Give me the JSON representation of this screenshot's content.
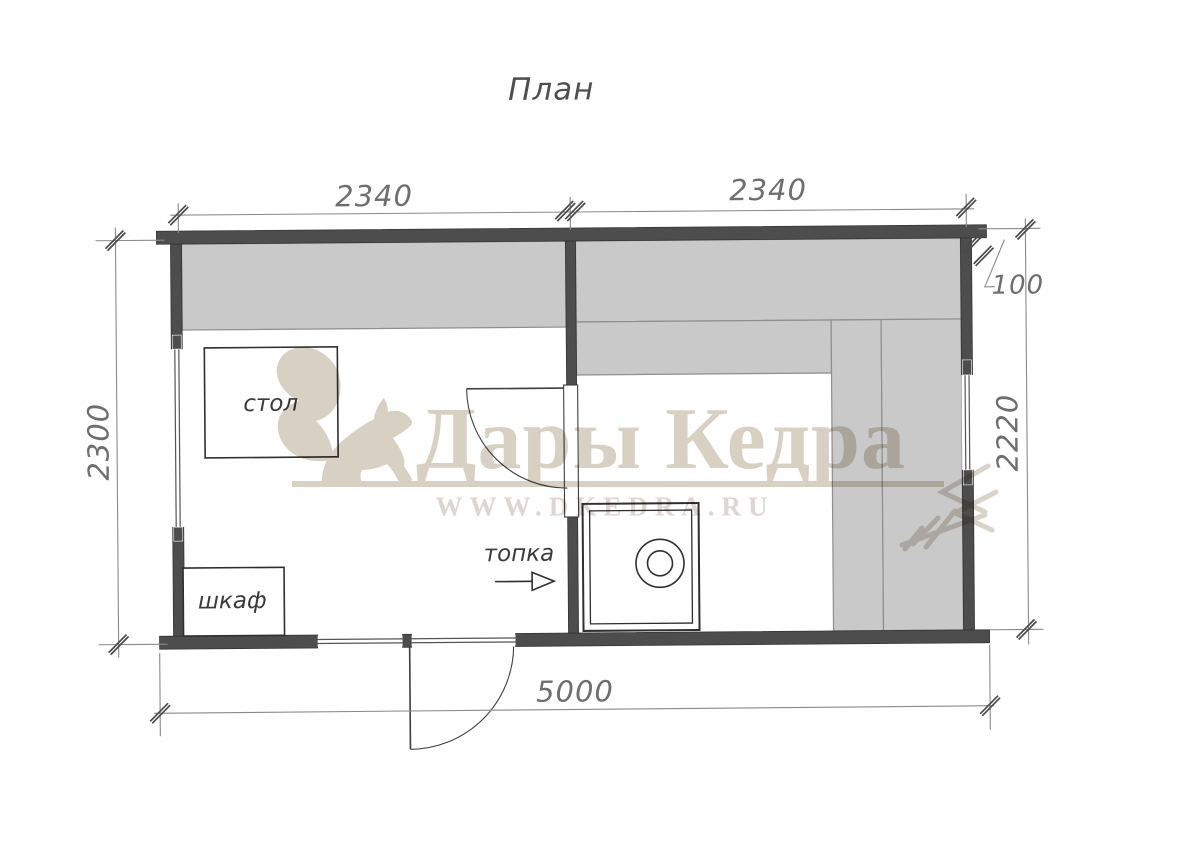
{
  "title": "План",
  "dimensions": {
    "top_left_mm": "2340",
    "top_right_mm": "2340",
    "wall_thickness_mm": "100",
    "left_mm": "2300",
    "right_mm": "2220",
    "bottom_mm": "5000"
  },
  "labels": {
    "table": "стол",
    "cabinet": "шкаф",
    "stove_feed": "топка"
  },
  "watermark": {
    "brand": "Дары Кедра",
    "website": "WWW.DKEDRA.RU"
  },
  "colors": {
    "wall": "#4d4d4d",
    "bench": "#c9c9c9",
    "bench_border": "#8e8e8e",
    "line": "#3e3e3e",
    "dimension": "#8a8a8a",
    "dimension_text": "#6e6e6e",
    "watermark": "#d8d0c3",
    "watermark_url": "#ddd6d2",
    "label": "#3a3a3a"
  }
}
